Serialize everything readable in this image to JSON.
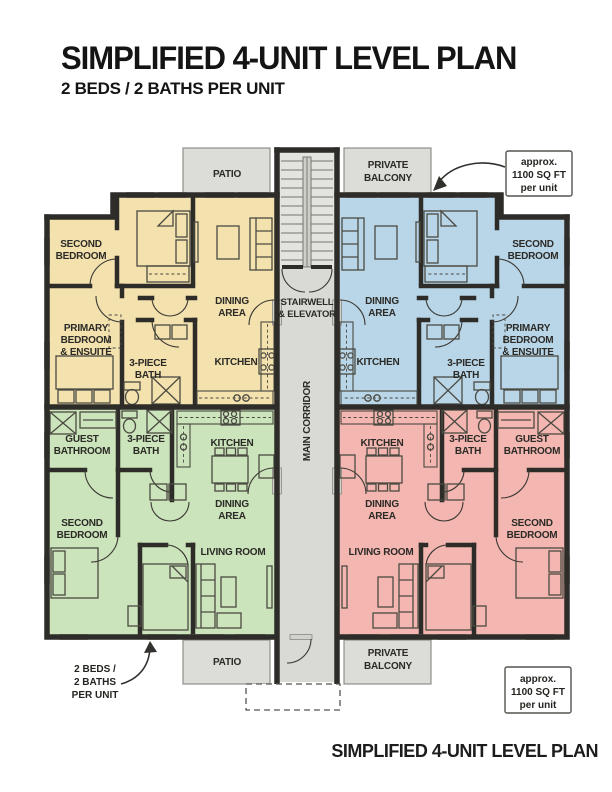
{
  "header": {
    "title": "SIMPLIFIED 4-UNIT LEVEL PLAN",
    "subtitle": "2 BEDS / 2 BATHS PER UNIT"
  },
  "footer": {
    "title": "SIMPLIFIED 4-UNIT LEVEL PLAN"
  },
  "common_areas": {
    "patio_top": "PATIO",
    "balcony_top": {
      "l1": "PRIVATE",
      "l2": "BALCONY"
    },
    "stairwell": {
      "l1": "STAIRWELL",
      "l2": "& ELEVATOR"
    },
    "main_corridor": "MAIN CORRIDOR",
    "patio_bottom": "PATIO",
    "balcony_bottom": {
      "l1": "PRIVATE",
      "l2": "BALCONY"
    }
  },
  "units": {
    "top_left": {
      "color": "#f3e1ae",
      "rooms": {
        "second_bedroom": {
          "l1": "SECOND",
          "l2": "BEDROOM"
        },
        "primary_bedroom": {
          "l1": "PRIMARY",
          "l2": "BEDROOM",
          "l3": "& ENSUITE"
        },
        "bath": {
          "l1": "3-PIECE",
          "l2": "BATH"
        },
        "dining": {
          "l1": "DINING",
          "l2": "AREA"
        },
        "kitchen": "KITCHEN"
      }
    },
    "top_right": {
      "color": "#b9d6e8",
      "rooms": {
        "second_bedroom": {
          "l1": "SECOND",
          "l2": "BEDROOM"
        },
        "primary_bedroom": {
          "l1": "PRIMARY",
          "l2": "BEDROOM",
          "l3": "& ENSUITE"
        },
        "bath": {
          "l1": "3-PIECE",
          "l2": "BATH"
        },
        "dining": {
          "l1": "DINING",
          "l2": "AREA"
        },
        "kitchen": "KITCHEN"
      }
    },
    "bottom_left": {
      "color": "#cbe4bb",
      "rooms": {
        "guest_bathroom": {
          "l1": "GUEST",
          "l2": "BATHROOM"
        },
        "bath": {
          "l1": "3-PIECE",
          "l2": "BATH"
        },
        "kitchen": "KITCHEN",
        "dining": {
          "l1": "DINING",
          "l2": "AREA"
        },
        "second_bedroom": {
          "l1": "SECOND",
          "l2": "BEDROOM"
        },
        "living_room": "LIVING ROOM"
      }
    },
    "bottom_right": {
      "color": "#f3b6b0",
      "rooms": {
        "guest_bathroom": {
          "l1": "GUEST",
          "l2": "BATHROOM"
        },
        "bath": {
          "l1": "3-PIECE",
          "l2": "BATH"
        },
        "kitchen": "KITCHEN",
        "dining": {
          "l1": "DINING",
          "l2": "AREA"
        },
        "second_bedroom": {
          "l1": "SECOND",
          "l2": "BEDROOM"
        },
        "living_room": "LIVING ROOM"
      }
    }
  },
  "annotations": {
    "sqft_top": {
      "l1": "approx.",
      "l2": "1100 SQ FT",
      "l3": "per unit"
    },
    "sqft_bottom": {
      "l1": "approx.",
      "l2": "1100 SQ FT",
      "l3": "per unit"
    },
    "beds_note": {
      "l1": "2 BEDS /",
      "l2": "2 BATHS",
      "l3": "PER UNIT"
    }
  },
  "colors": {
    "wall": "#2e2c28",
    "corridor": "#d9d9d5",
    "stairs": "#e3e3e0",
    "patio": "#dcdcd8"
  }
}
